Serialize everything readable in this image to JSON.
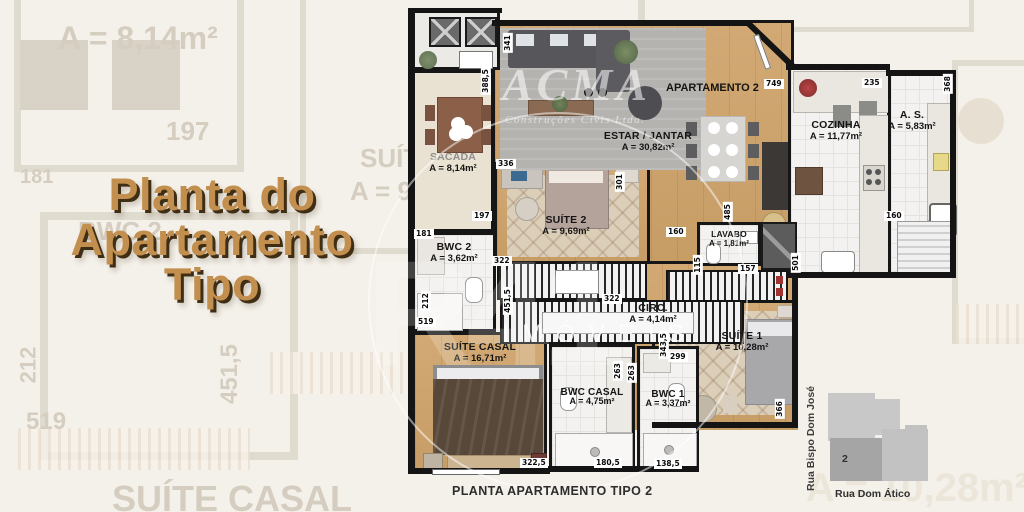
{
  "title": {
    "l1": "Planta do",
    "l2": "Apartamento",
    "l3": "Tipo"
  },
  "caption": "PLANTA APARTAMENTO TIPO 2",
  "apartment_label": "APARTAMENTO 2",
  "watermark": {
    "logo": "ACMA",
    "sub": "Construções Civis Ltda.",
    "brand": "IMÓVEIS",
    "ghost": "R41"
  },
  "rooms": {
    "sacada": {
      "name": "SACADA",
      "area": "A = 8,14m²"
    },
    "estar": {
      "name": "ESTAR / JANTAR",
      "area": "A = 30,82m²"
    },
    "cozinha": {
      "name": "COZINHA",
      "area": "A = 11,77m²"
    },
    "as": {
      "name": "A. S.",
      "area": "A = 5,83m²"
    },
    "suite2": {
      "name": "SUÍTE 2",
      "area": "A = 9,69m²"
    },
    "bwc2": {
      "name": "BWC 2",
      "area": "A = 3,62m²"
    },
    "lavabo": {
      "name": "LAVABO",
      "area": "A = 1,81m²"
    },
    "circ": {
      "name": "CIRC.",
      "area": "A = 4,14m²"
    },
    "suite1": {
      "name": "SUÍTE 1",
      "area": "A = 10,28m²"
    },
    "suite_casal": {
      "name": "SUÍTE CASAL",
      "area": "A = 16,71m²"
    },
    "bwc_casal": {
      "name": "BWC CASAL",
      "area": "A = 4,75m²"
    },
    "bwc1": {
      "name": "BWC 1",
      "area": "A = 3,37m²"
    }
  },
  "dims": [
    "388,5",
    "341",
    "336",
    "197",
    "181",
    "212",
    "519",
    "451,5",
    "322",
    "322",
    "301",
    "485",
    "160",
    "115",
    "157",
    "501",
    "749",
    "235",
    "368",
    "160",
    "343,5",
    "299",
    "263",
    "263",
    "366",
    "322,5",
    "180,5",
    "138,5"
  ],
  "bg": [
    "A = 8,14m²",
    "197",
    "181",
    "BWC 2",
    "SUÍTE",
    "A = 9,",
    "212",
    "519",
    "451,5",
    "SUÍTE CASAL",
    "A = 10,28m²"
  ],
  "sitemap": {
    "unit": "2",
    "street_left": "Rua Bispo Dom José",
    "street_bottom": "Rua Dom Ático"
  }
}
